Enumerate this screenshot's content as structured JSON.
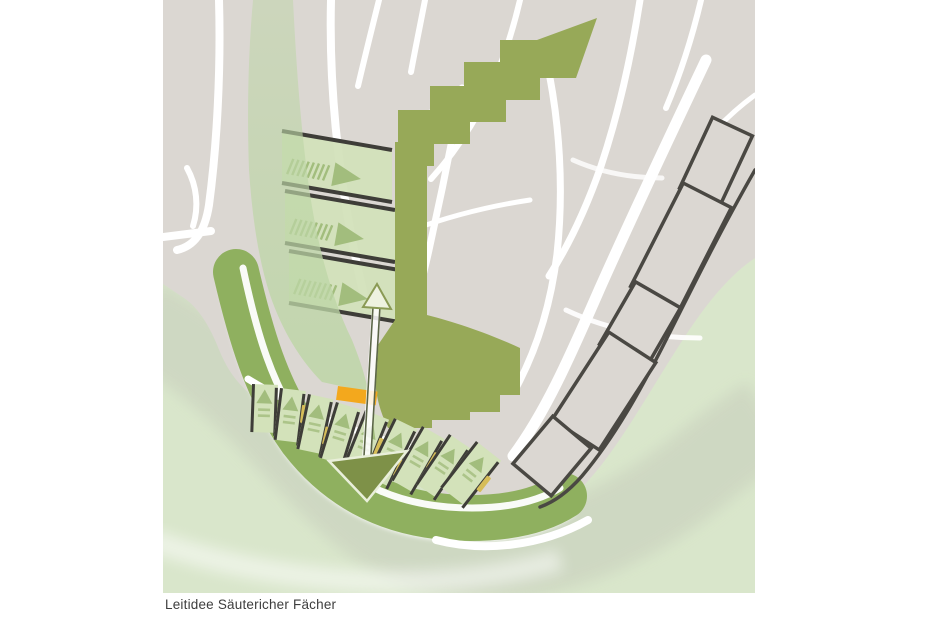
{
  "page": {
    "background": "#ffffff"
  },
  "caption": {
    "text": "Leitidee Säutericher Fächer"
  },
  "map": {
    "kind": "urban-design-concept-plan",
    "colors": {
      "street_white": "#ffffff",
      "block_gray": "#dbd7d2",
      "landscape_light": "#d9e6cb",
      "landscape_band": "#cdd6c1",
      "green_route": "#97a958",
      "park_band": "#8fb05f",
      "plot_green": "#d3e2ba",
      "corridor_overlay": "#bdd6a6",
      "tree_green": "#a2bd7d",
      "outline_dark": "#3e3d38",
      "chain_outline": "#4a4843",
      "accent_orange": "#f3a81d",
      "accent_yellow": "#d6bd58",
      "arrow_shaft": "#5c6648",
      "arrowhead_fill": "#7e9148",
      "arrowhead_light": "#eef2e0",
      "caption_text": "#3d3d3d"
    },
    "arrow_block_shape": {
      "w": 110,
      "slope": 19,
      "h": 52
    },
    "arrow_blocks": [
      {
        "x": 282,
        "y": 131
      },
      {
        "x": 285,
        "y": 191
      },
      {
        "x": 289,
        "y": 251
      }
    ],
    "fan_plots": [
      {
        "x": 252,
        "y": 384,
        "a": 2,
        "h": 48,
        "m": null
      },
      {
        "x": 280,
        "y": 388,
        "a": 7,
        "h": 52,
        "m": 14
      },
      {
        "x": 308,
        "y": 394,
        "a": 12,
        "h": 56,
        "m": 28
      },
      {
        "x": 336,
        "y": 402,
        "a": 17,
        "h": 58,
        "m": null
      },
      {
        "x": 365,
        "y": 410,
        "a": 22,
        "h": 62,
        "m": 20
      },
      {
        "x": 394,
        "y": 418,
        "a": 26,
        "h": 64,
        "m": 34
      },
      {
        "x": 422,
        "y": 426,
        "a": 30,
        "h": 62,
        "m": 16
      },
      {
        "x": 449,
        "y": 434,
        "a": 34,
        "h": 60,
        "m": 30
      },
      {
        "x": 476,
        "y": 441,
        "a": 38,
        "h": 58,
        "m": 20,
        "w": 32
      }
    ],
    "chain_blocks": [
      {
        "cx": 716,
        "cy": 162,
        "w": 44,
        "h": 78,
        "r": 25
      },
      {
        "cx": 681,
        "cy": 247,
        "w": 54,
        "h": 116,
        "r": 27
      },
      {
        "cx": 640,
        "cy": 326,
        "w": 52,
        "h": 72,
        "r": 30
      },
      {
        "cx": 604,
        "cy": 391,
        "w": 56,
        "h": 104,
        "r": 33
      },
      {
        "cx": 552,
        "cy": 456,
        "w": 50,
        "h": 62,
        "r": 40
      }
    ]
  }
}
